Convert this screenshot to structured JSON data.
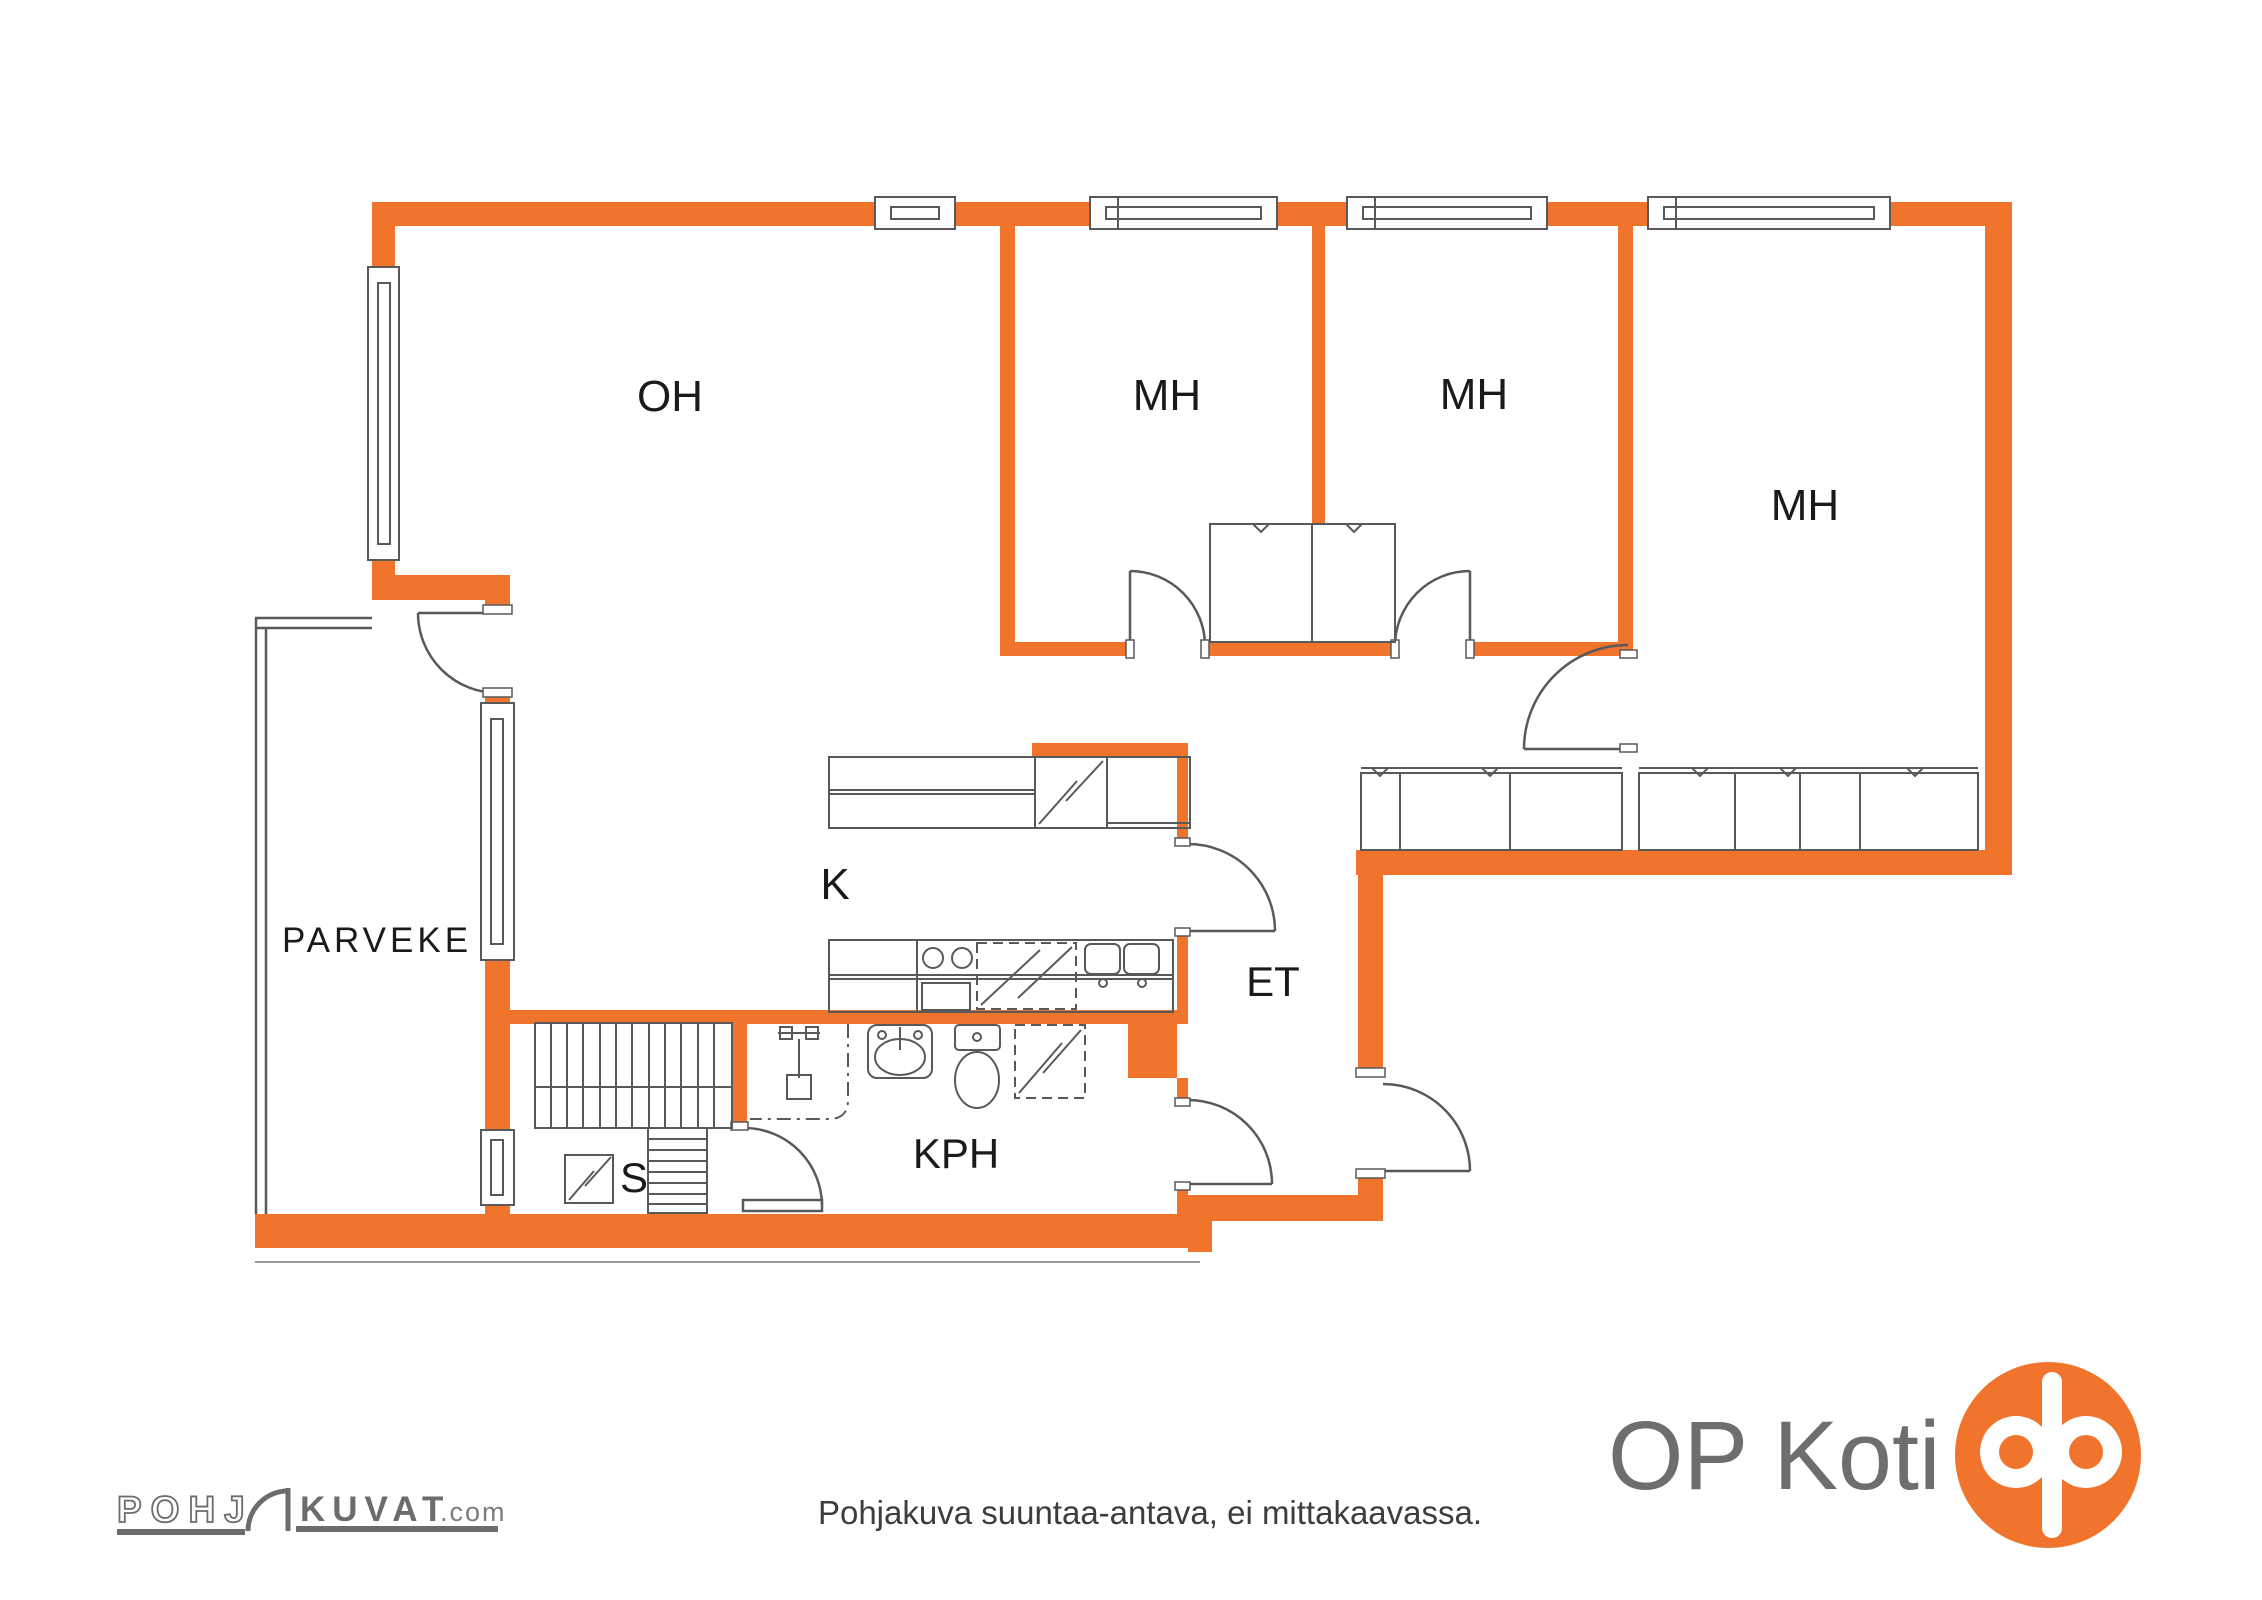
{
  "rooms": {
    "living": "OH",
    "bedroom1": "MH",
    "bedroom2": "MH",
    "bedroom3": "MH",
    "kitchen": "K",
    "entry": "ET",
    "bathroom": "KPH",
    "sauna": "S",
    "balcony": "PARVEKE"
  },
  "footer": {
    "disclaimer": "Pohjakuva suuntaa-antava, ei mittakaavassa."
  },
  "logos": {
    "pohjakuvat": {
      "part1": "POHJ",
      "part2": "KUVAT",
      "suffix": ".com"
    },
    "opkoti": {
      "text": "OP Koti"
    }
  },
  "colors": {
    "wall_orange": "#F0742C",
    "line_gray": "#58595B",
    "label_black": "#1A1A1A",
    "logo_gray": "#6D6E70"
  },
  "icons": {
    "stairs": "hatched-rect",
    "sauna_heater": "square-lightning",
    "fridge": "box-lightning",
    "dishwasher": "dashed-box-lightning",
    "washing_machine": "dashed-box-lightning",
    "toilet": "tank-and-bowl",
    "washbasin": "oval-in-box",
    "shower": "mixer-bar",
    "wardrobe": "box-with-v-marks",
    "door": "quarter-arc",
    "window": "double-line-box",
    "op_emblem": "orange-circle-double-ring"
  }
}
